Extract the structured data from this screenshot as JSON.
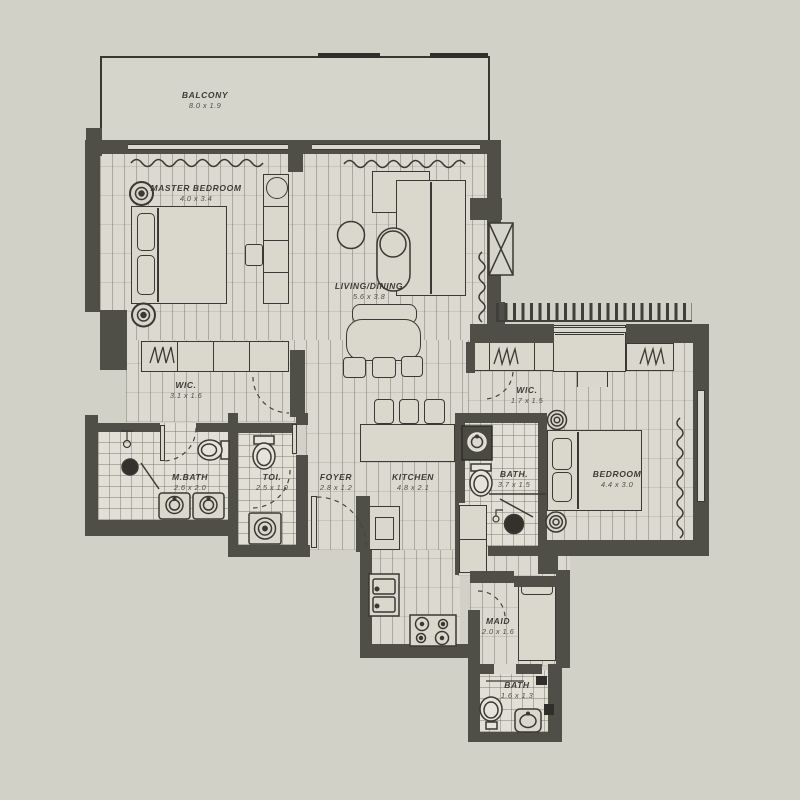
{
  "plan": {
    "type": "apartment-floor-plan",
    "rooms": {
      "balcony": {
        "label": "BALCONY",
        "dims": "8.0 x 1.9"
      },
      "master_bedroom": {
        "label": "MASTER BEDROOM",
        "dims": "4.0 x 3.4"
      },
      "living_dining": {
        "label": "LIVING/DINING",
        "dims": "5.6 x 3.8"
      },
      "wic_master": {
        "label": "WIC.",
        "dims": "3.1 x 1.6"
      },
      "master_bath": {
        "label": "M.BATH",
        "dims": "2.6 x 2.0"
      },
      "toilet": {
        "label": "TOI.",
        "dims": "2.5 x 1.0"
      },
      "foyer": {
        "label": "FOYER",
        "dims": "2.8 x 1.2"
      },
      "kitchen": {
        "label": "KITCHEN",
        "dims": "4.8 x 2.1"
      },
      "wic_bedroom": {
        "label": "WIC.",
        "dims": "1.7 x 1.5"
      },
      "bath": {
        "label": "BATH.",
        "dims": "3.7 x 1.5"
      },
      "bedroom": {
        "label": "BEDROOM",
        "dims": "4.4 x 3.0"
      },
      "maid": {
        "label": "MAID",
        "dims": "2.0 x 1.6"
      },
      "maid_bath": {
        "label": "BATH",
        "dims": "1.6 x 1.3"
      }
    },
    "fixtures": [
      "bed",
      "pillows",
      "nightstand",
      "wardrobe-hangers",
      "sofa",
      "coffee-table",
      "dining-table",
      "bar-stool",
      "kitchen-island",
      "stove-4-burner",
      "double-sink",
      "fridge",
      "toilet",
      "vanity-sink",
      "shower-drain",
      "washing-machine",
      "door-swing",
      "curtain",
      "ac-shaft",
      "window"
    ],
    "colors": {
      "background": "#d2d1c8",
      "wall": "#4f4e47",
      "wall_dark": "#2f2e2a",
      "floor": "#dcdad0",
      "tile": "#e2e0d6",
      "line": "#3a3933",
      "text": "#3c3b35"
    }
  }
}
